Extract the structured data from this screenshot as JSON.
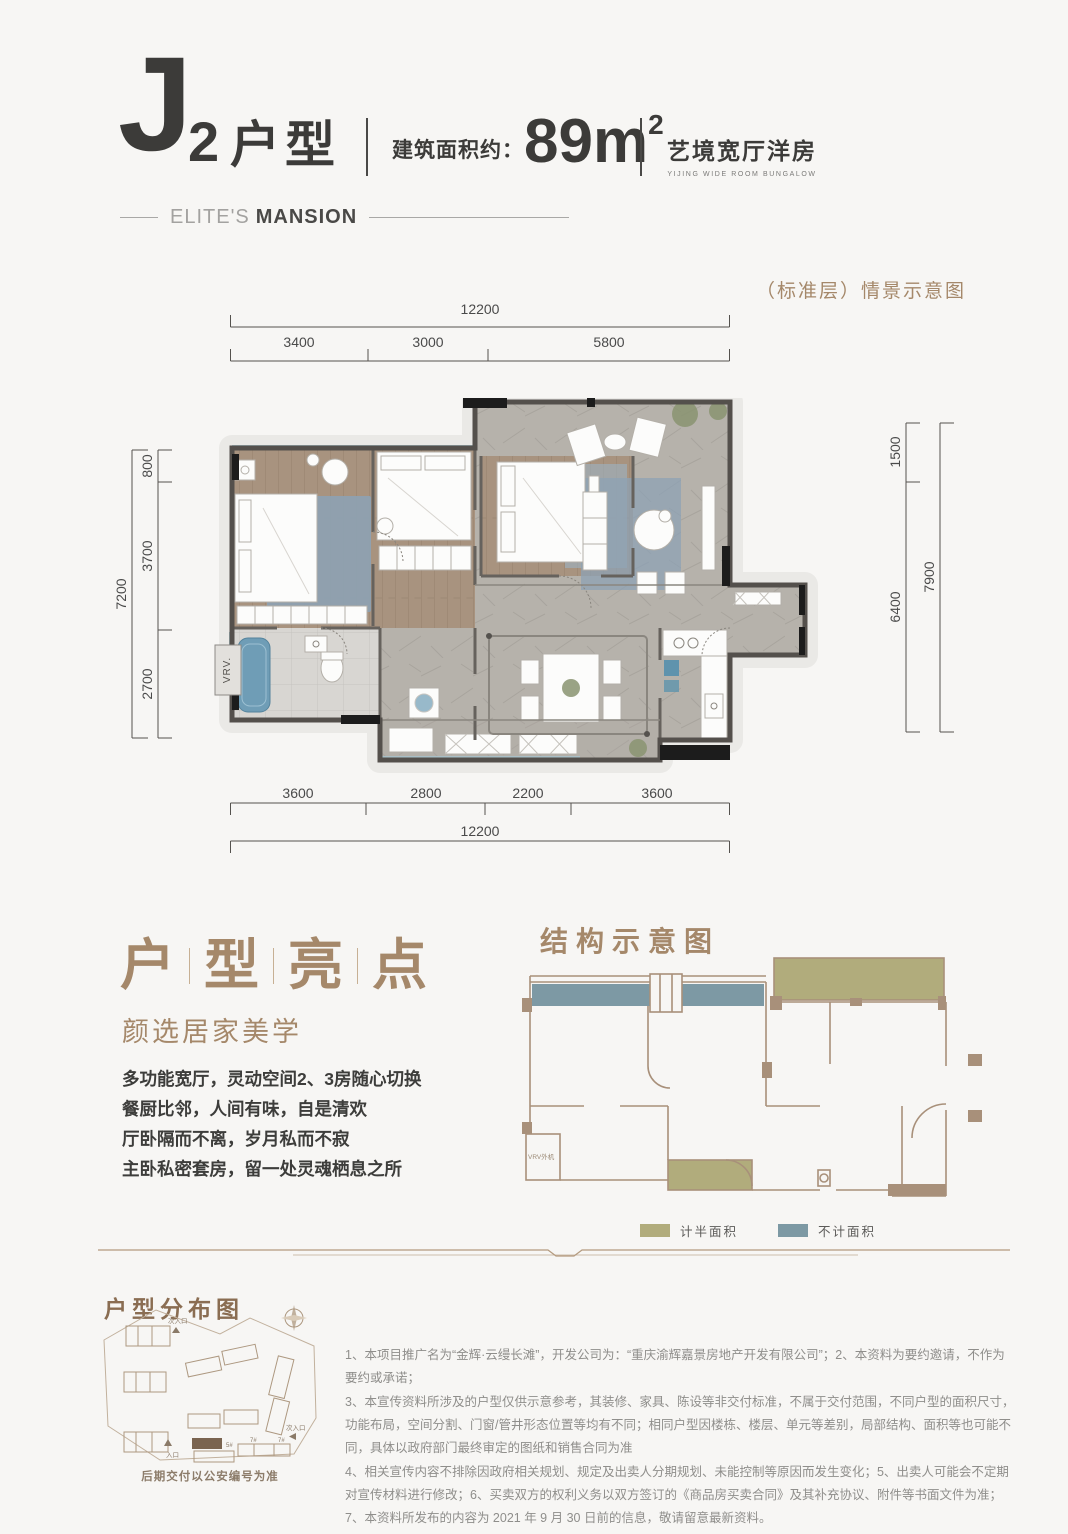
{
  "colors": {
    "accent_brown": "#a5886a",
    "legend_half_area": "#b1ac7c",
    "legend_no_area": "#7d99a4",
    "wood_floor": "#a8937f",
    "rug_blue": "#8da2b4"
  },
  "header": {
    "unit_big_letter": "J",
    "unit_number": "2",
    "unit_type": "户型",
    "area_label": "建筑面积约：",
    "area_value": "89m",
    "area_exponent": "2",
    "tagline_cn": "艺境宽厅洋房",
    "tagline_en": "YIJING WIDE ROOM BUNGALOW",
    "brand_light": "ELITE'S",
    "brand_bold": "MANSION"
  },
  "floorplan": {
    "caption": "（标准层）情景示意图",
    "vrv_label": "VRV.",
    "dims": {
      "top_total": "12200",
      "top_segments": [
        "3400",
        "3000",
        "5800"
      ],
      "left_total": "7200",
      "left_segments": [
        "800",
        "3700",
        "2700"
      ],
      "right_total": "7900",
      "right_segments": [
        "1500",
        "6400"
      ],
      "bottom_segments": [
        "3600",
        "2800",
        "2200",
        "3600"
      ],
      "bottom_total": "12200"
    }
  },
  "highlights": {
    "title_chars": [
      "户",
      "型",
      "亮",
      "点"
    ],
    "subtitle": "颜选居家美学",
    "lines": [
      "多功能宽厅，灵动空间2、3房随心切换",
      "餐厨比邻，人间有味，自是清欢",
      "厅卧隔而不离，岁月私而不寂",
      "主卧私密套房，留一处灵魂栖息之所"
    ]
  },
  "structure": {
    "title": "结构示意图",
    "vrv_label": "VRV外机",
    "legend": [
      {
        "label": "计半面积",
        "color": "#b1ac7c"
      },
      {
        "label": "不计面积",
        "color": "#7d99a4"
      }
    ]
  },
  "distribution": {
    "title": "户型分布图",
    "main_entrance": "入口",
    "secondary_entrance": "次入口",
    "building_labels": [
      "5#",
      "7#",
      "7#"
    ],
    "caption": "后期交付以公安编号为准"
  },
  "disclaimer": {
    "paragraphs": [
      "1、本项目推广名为“金辉·云缦长滩”，开发公司为：“重庆渝辉嘉景房地产开发有限公司”；2、本资料为要约邀请，不作为要约或承诺；",
      "3、本宣传资料所涉及的户型仅供示意参考，其装修、家具、陈设等非交付标准，不属于交付范围，不同户型的面积尺寸，功能布局，空间分割、门窗/管井形态位置等均有不同；相同户型因楼栋、楼层、单元等差别，局部结构、面积等也可能不同，具体以政府部门最终审定的图纸和销售合同为准",
      "4、相关宣传内容不排除因政府相关规划、规定及出卖人分期规划、未能控制等原因而发生变化；5、出卖人可能会不定期对宣传材料进行修改；6、买卖双方的权利义务以双方签订的《商品房买卖合同》及其补充协议、附件等书面文件为准；7、本资料所发布的内容为 2021 年 9 月 30 日前的信息，敬请留意最新资料。"
    ]
  }
}
